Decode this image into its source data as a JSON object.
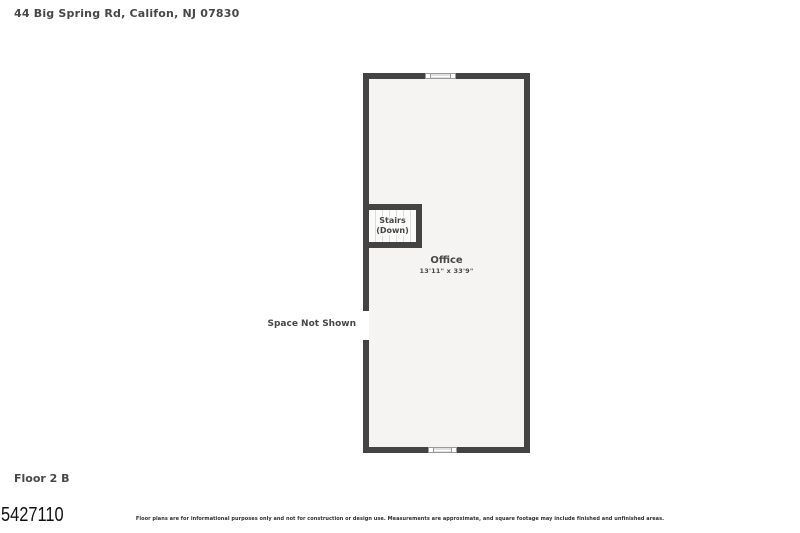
{
  "header": {
    "address": "44 Big Spring Rd, Califon, NJ 07830"
  },
  "floor_plan": {
    "rooms": {
      "office": {
        "name": "Office",
        "dimensions": "13'11\" x 33'9\""
      },
      "stairs": {
        "label_line1": "Stairs",
        "label_line2": "(Down)"
      }
    },
    "annotations": {
      "space_not_shown": "Space Not Shown"
    },
    "colors": {
      "wall": "#434343",
      "room_fill": "#f5f4f2",
      "window_fill": "#e0e0e0",
      "text": "#474747"
    }
  },
  "footer": {
    "floor_label": "Floor 2 B",
    "listing_number": "5427110",
    "disclaimer": "Floor plans are for informational purposes only and not for construction or design use. Measurements are approximate, and square footage may include finished and unfinished areas."
  }
}
